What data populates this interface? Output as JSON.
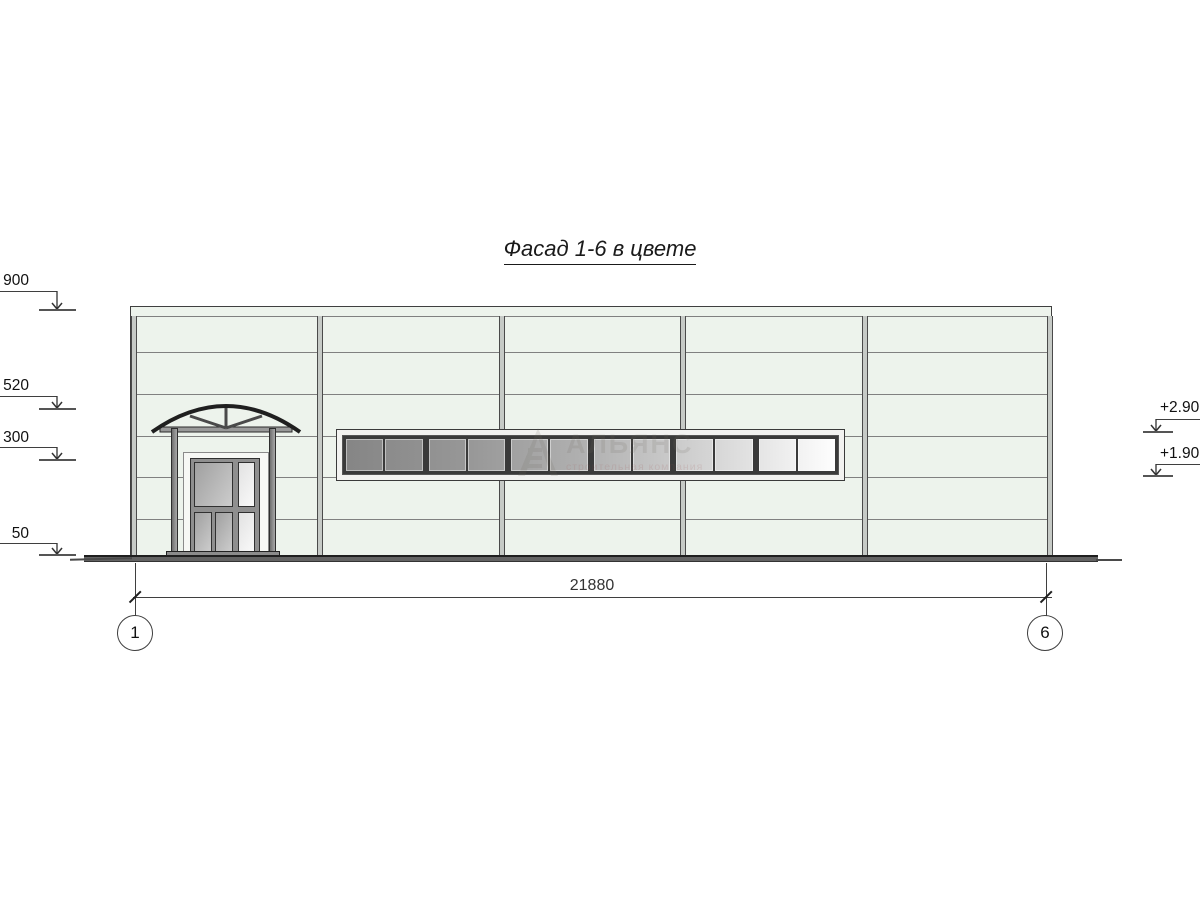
{
  "title": "Фасад 1-6 в цвете",
  "dimension_label": "21880",
  "axis_markers": [
    "1",
    "6"
  ],
  "elevation_marks_left": [
    "900",
    "520",
    "300",
    "50"
  ],
  "elevation_marks_right": [
    "+2.90",
    "+1.90"
  ],
  "watermark": {
    "name": "АЛЬЯНС",
    "subtitle": "строительная компания"
  },
  "facade": {
    "bays": 5,
    "horizontal_joints": 6,
    "panel_color": "#edf3ec"
  },
  "window_strip": {
    "groups": 6,
    "panes_per_group": 2,
    "glass_gradient": [
      "#858585",
      "#979797",
      "#b2b2b2",
      "#d6d6d6",
      "#ffffff"
    ]
  },
  "colors": {
    "line": "#3f3f3f",
    "ground": "#636363",
    "mullion": "#c6cac6",
    "door_frame": "#8f8f8f"
  }
}
